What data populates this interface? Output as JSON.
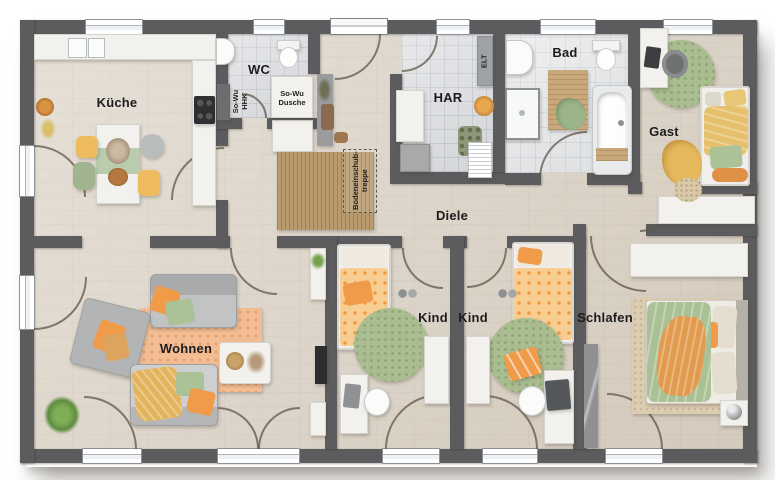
{
  "rooms": {
    "kueche": "Küche",
    "wc": "WC",
    "har": "HAR",
    "bad": "Bad",
    "gast": "Gast",
    "diele": "Diele",
    "wohnen": "Wohnen",
    "kind1": "Kind",
    "kind2": "Kind",
    "schlafen": "Schlafen"
  },
  "annotations": {
    "shower_line1": "So-Wu",
    "shower_line2": "Dusche",
    "radiator_line1": "So-Wu",
    "radiator_line2": "HHK",
    "electrical": "ELT",
    "attic_line1": "Bodeneinschub-",
    "attic_line2": "treppe"
  },
  "palette": {
    "wall": "#5c5c5e",
    "wood_floor": "#dbd2c5",
    "tile_floor": "#dadcdf",
    "accent_orange": "#ef9b3f",
    "accent_green": "#a9bd90",
    "accent_yellow": "#e2b45e",
    "furniture_white": "#f2f1ee"
  }
}
